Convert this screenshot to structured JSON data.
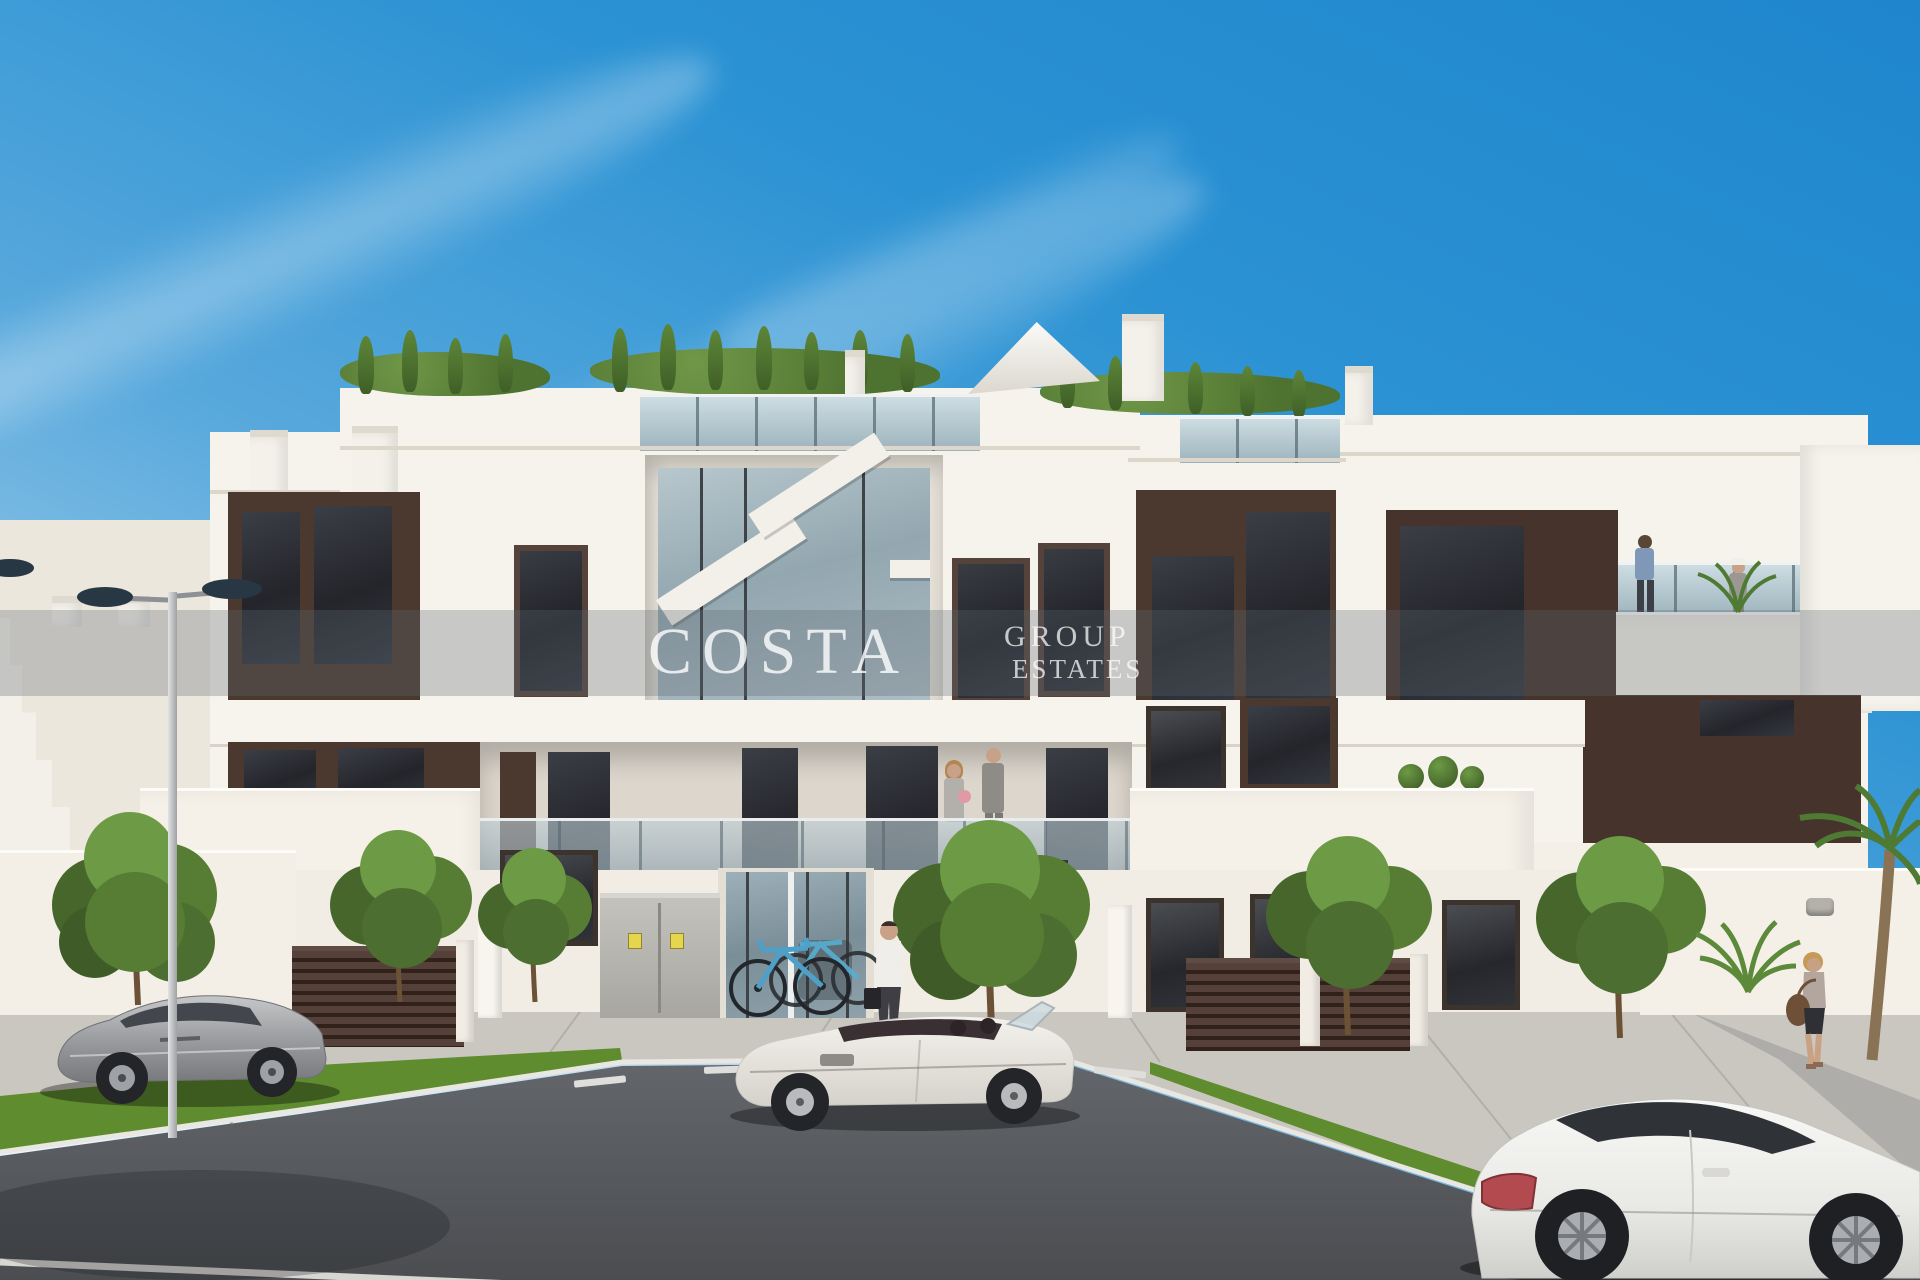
{
  "watermark": {
    "brand": "COSTA",
    "suffix_line1": "GROUP",
    "suffix_line2": "ESTATES"
  },
  "palette": {
    "sky_top": "#1f86cd",
    "sky_horizon": "#d9eef9",
    "facade": "#f6f3ec",
    "facade_shade": "#e2dcd1",
    "accent_brown": "#4b382f",
    "fence_brown": "#31211b",
    "glass": "#9fb4be",
    "window_dark": "#2f3136",
    "grass": "#5f8c2e",
    "road": "#54565a",
    "sidewalk": "#cac7c1",
    "bike_blue": "#4fa0c8"
  }
}
